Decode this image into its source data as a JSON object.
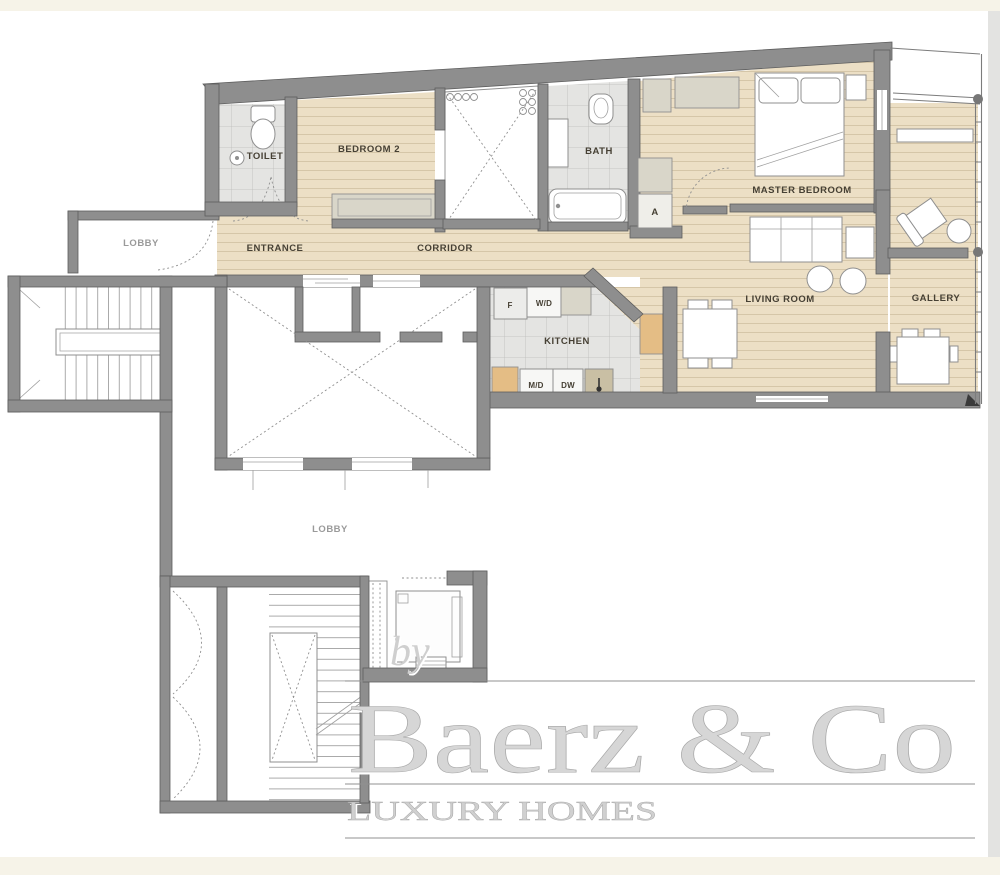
{
  "rooms": {
    "toilet": "TOILET",
    "bedroom2": "BEDROOM 2",
    "bath": "BATH",
    "master_bedroom": "MASTER BEDROOM",
    "lobby_upper": "LOBBY",
    "entrance": "ENTRANCE",
    "corridor": "CORRIDOR",
    "kitchen": "KITCHEN",
    "living_room": "LIVING ROOM",
    "gallery": "GALLERY",
    "lobby_main": "LOBBY",
    "closet_a": "A"
  },
  "appliances": {
    "fridge": "F",
    "washer_dryer": "W/D",
    "microwave_drawer": "M/D",
    "dishwasher": "DW"
  },
  "watermark": {
    "prefix": "by",
    "brand": "Baerz & Co",
    "tagline": "LUXURY HOMES"
  },
  "colors": {
    "wall": "#8e8e8e",
    "wood_floor": "#ecdfc5",
    "wood_plank_line": "#d5c6a8",
    "tile_floor": "#e4e4e2",
    "tile_line": "#bcbcba",
    "cabinet_tan": "#e4bd85",
    "cabinet_gray": "#d9d6c9",
    "label_dark": "#464034",
    "label_gray": "#9a9a9a",
    "watermark_gray": "#d6d6d6",
    "page_band_cream": "#f6f3e8"
  }
}
